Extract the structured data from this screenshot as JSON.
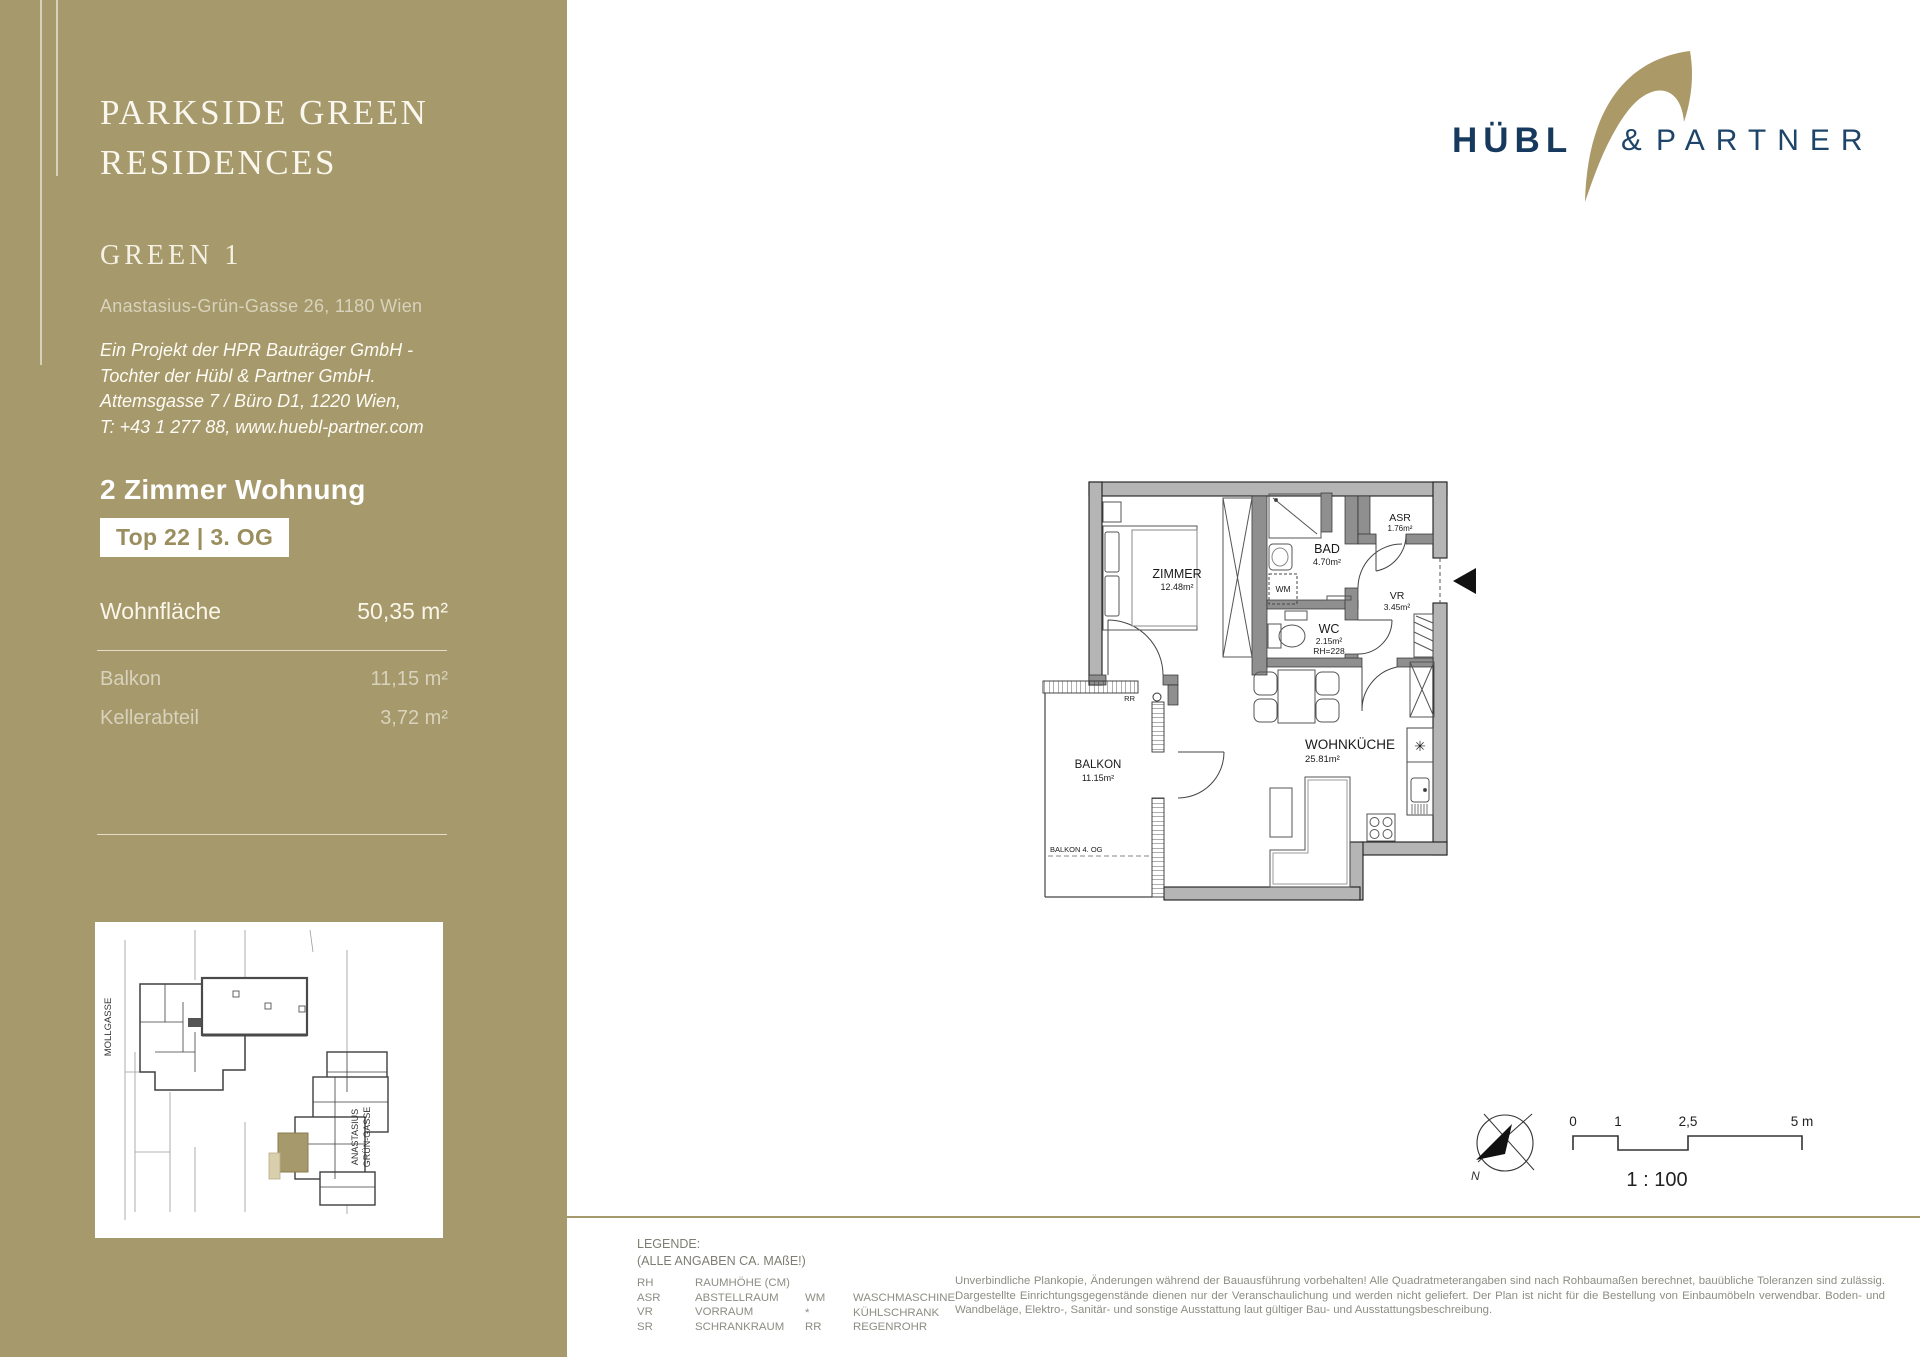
{
  "doc": {
    "title_line1": "PARKSIDE GREEN",
    "title_line2": "RESIDENCES",
    "project": "GREEN 1",
    "address": "Anastasius-Grün-Gasse 26, 1180 Wien",
    "dev1": "Ein Projekt der HPR Bauträger GmbH -",
    "dev2": "Tochter der Hübl & Partner GmbH.",
    "dev3": "Attemsgasse 7 / Büro D1, 1220 Wien,",
    "dev4": "T: +43 1 277 88, www.huebl-partner.com",
    "unit_type": "2 Zimmer Wohnung",
    "unit_badge": "Top 22 | 3. OG",
    "area_main_label": "Wohnfläche",
    "area_main_value": "50,35 m²",
    "area2_label": "Balkon",
    "area2_value": "11,15 m²",
    "area3_label": "Kellerabteil",
    "area3_value": "3,72 m²"
  },
  "siteplan": {
    "street_left": "MOLLGASSE",
    "street_right1": "ANASTASIUS",
    "street_right2": "GRÜN-GASSE"
  },
  "logo": {
    "word1": "HÜBL",
    "amp": "&",
    "word2": "PARTNER"
  },
  "plan": {
    "zimmer": "ZIMMER",
    "zimmer_area": "12.48m²",
    "bad": "BAD",
    "bad_area": "4.70m²",
    "asr": "ASR",
    "asr_area": "1.76m²",
    "vr": "VR",
    "vr_area": "3.45m²",
    "wc": "WC",
    "wc_area": "2.15m²",
    "wc_rh": "RH=228",
    "kueche": "WOHNKÜCHE",
    "kueche_area": "25.81m²",
    "balkon": "BALKON",
    "balkon_area": "11.15m²",
    "balkon4": "BALKON 4. OG",
    "wm": "WM",
    "rr": "RR",
    "fridge": "✳"
  },
  "scalebar": {
    "t0": "0",
    "t1": "1",
    "t25": "2,5",
    "t5": "5 m",
    "ratio": "1 : 100",
    "north": "N"
  },
  "legend": {
    "title": "LEGENDE:",
    "subtitle": "(ALLE ANGABEN CA. MAßE!)",
    "l": [
      [
        "RH",
        "RAUMHÖHE (CM)"
      ],
      [
        "ASR",
        "ABSTELLRAUM"
      ],
      [
        "VR",
        "VORRAUM"
      ],
      [
        "SR",
        "SCHRANKRAUM"
      ]
    ],
    "r": [
      [
        "WM",
        "WASCHMASCHINE"
      ],
      [
        "*",
        "KÜHLSCHRANK"
      ],
      [
        "RR",
        "REGENROHR"
      ]
    ]
  },
  "disclaimer": "Unverbindliche Plankopie, Änderungen während der Bauausführung vorbehalten! Alle Quadratmeterangaben sind nach Rohbaumaßen berechnet, bauübliche Toleranzen sind zulässig.  Dargestellte Einrichtungsgegenstände dienen nur der Veranschaulichung und werden nicht geliefert. Der Plan ist nicht für die Bestellung von Einbaumöbeln verwendbar. Boden- und Wandbeläge, Elektro-, Sanitär- und sonstige Ausstattung laut gültiger Bau- und Ausstattungsbeschreibung.",
  "colors": {
    "gold": "#a6996b",
    "navy": "#16395d",
    "navy_light": "#1e4569",
    "arc_gold": "#ab9967"
  }
}
